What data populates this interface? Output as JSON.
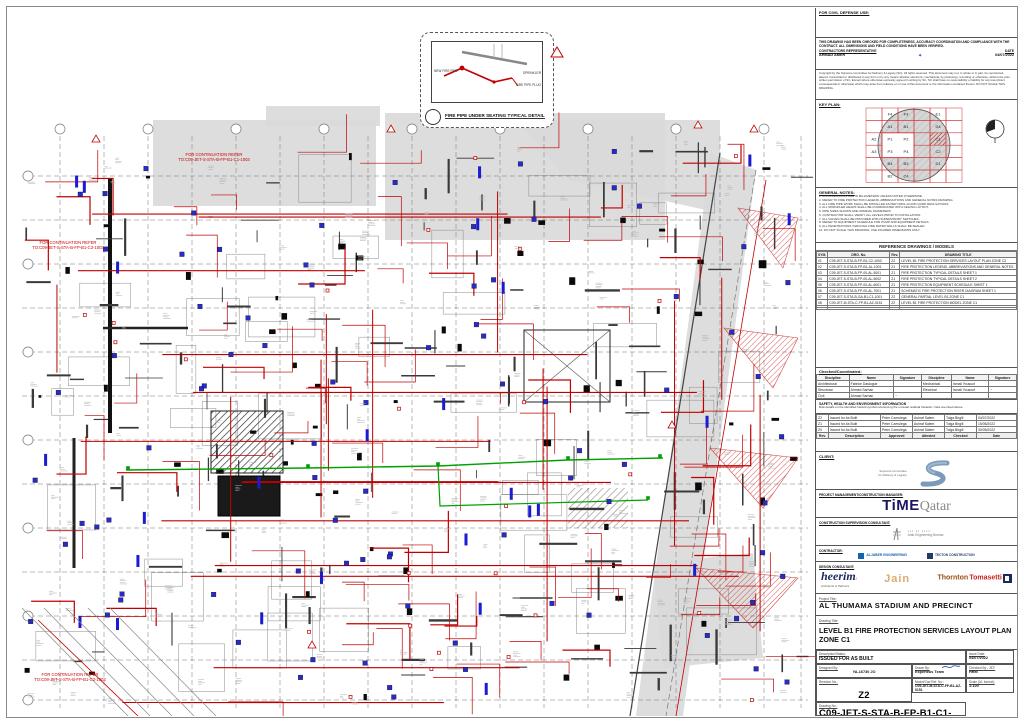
{
  "civil_defense": {
    "label": "FOR CIVIL DEFENSE USE:"
  },
  "compliance": {
    "statement": "THIS DRAWING HAS BEEN CHECKED FOR COMPLETENESS, ACCURACY COORDINATION AND COMPLIANCE WITH THE CONTRACT. ALL DIMENSIONS AND FIELD CONDITIONS HAVE BEEN VERIFIED.",
    "rep_label": "CONTRACTORS REPRESENTATIVE",
    "rep_name": "AHMAD AMER",
    "date_label": "DATE",
    "date": "04/07/2022"
  },
  "copyright": "Copyright by the Supreme Committee for Delivery & Legacy (SC). All rights reserved. This document may not, in whole or in part, be reproduced, altered, transmitted or distributed in any form or by any means whether electronic, mechanical, by photocopy, recording or otherwise, without the prior written permission of SC. Except where otherwise expressly agreed in writing by SC, SC shall have no responsibility or liability for any loss (direct, consequential or otherwise) which may arise from reliance on or use of this document or the information contained therein. DO NOT SCALE THIS DRAWING.",
  "keyplan": {
    "label": "KEY PLAN:",
    "grid": [
      [
        "",
        "F4",
        "F3",
        "",
        "E1",
        ""
      ],
      [
        "",
        "A1",
        "B1",
        "",
        "D4",
        ""
      ],
      [
        "A2",
        "P1",
        "P2",
        "",
        "C1",
        ""
      ],
      [
        "A3",
        "P3",
        "P4",
        "",
        "C2",
        ""
      ],
      [
        "",
        "B4",
        "B3",
        "",
        "D1",
        ""
      ],
      [
        "",
        "B2",
        "C4",
        "",
        "",
        ""
      ]
    ],
    "highlight_zone": "C1"
  },
  "general_notes": {
    "title": "GENERAL NOTES:",
    "lines": [
      "1. ALL DIMENSIONS ARE IN MILLIMETERS UNLESS NOTED OTHERWISE.",
      "2. REFER TO FIRE PROTECTION LEGEND, ABBREVIATIONS AND GENERAL NOTES DRAWING.",
      "3. ALL FIRE PIPE WORK SHALL BE INSTALLED AS PER NFPA-13 AND QCDD REGULATIONS.",
      "4. ALL SPRINKLER HEADS SHALL BE COORDINATED WITH CEILING LAYOUT.",
      "5. PIPE SIZES SHOWN ARE NOMINAL DIAMETERS.",
      "6. CONTRACTOR SHALL VERIFY ALL LEVELS PRIOR TO INSTALLATION.",
      "7. ALL VALVES SHALL BE PROVIDED WITH SUPERVISORY SWITCHES.",
      "8. REFER TO EQUIPMENT SCHEDULE FOR PUMP AND EQUIPMENT DETAILS.",
      "9. ALL PENETRATIONS THROUGH FIRE RATED WALLS SHALL BE SEALED.",
      "10. DO NOT SCALE THIS DRAWING; USE FIGURED DIMENSIONS ONLY."
    ]
  },
  "reference_table": {
    "title": "REFERENCE DRAWINGS / MODELS",
    "headers": [
      "SYM.",
      "DRG. No.",
      "Rev.",
      "DRAWING TITLE"
    ],
    "rows": [
      [
        "01",
        "C09-JET-S-STA-B-FP-B1-C2-1003",
        "Z2",
        "LEVEL B1 FIRE PROTECTION SERVICES LAYOUT PLAN ZONE C2"
      ],
      [
        "02",
        "C09-JET-S-STA-B-FP-B1-AL-1001",
        "Z1",
        "FIRE PROTECTION LEGEND, ABBREVIATIONS AND GENERAL NOTES"
      ],
      [
        "03",
        "C09-JET-S-STA-B-FP-00-AL-5001",
        "Z1",
        "FIRE PROTECTION TYPICAL DETAILS SHEET 1"
      ],
      [
        "04",
        "C09-JET-S-STA-B-FP-00-AL-5002",
        "Z1",
        "FIRE PROTECTION TYPICAL DETAILS SHEET 2"
      ],
      [
        "05",
        "C09-JET-S-STA-B-FP-00-AL-6001",
        "Z1",
        "FIRE PROTECTION EQUIPMENT SCHEDULE SHEET 1"
      ],
      [
        "06",
        "C09-JET-S-STA-B-FP-00-AL-7001",
        "Z1",
        "SCHEMATIC FIRE PROTECTION RISER DIAGRAM SHEET 1"
      ],
      [
        "07",
        "C09-JET-S-STA-B-GA-B1-C1-1001",
        "Z2",
        "GENERAL PARTIAL LEVEL B1 ZONE C1"
      ],
      [
        "08",
        "C09-JET-M-STA-C-FP-B1-AZ-0151",
        "Z2",
        "LEVEL B1 FIRE PROTECTION MODEL ZONE C1"
      ],
      [
        "",
        "",
        "",
        ""
      ],
      [
        "",
        "",
        "",
        ""
      ]
    ]
  },
  "checked": {
    "title": "Checked/Coordinated:",
    "headers": [
      "Discipline",
      "Name",
      "Signature",
      "Discipline",
      "Name",
      "Signature"
    ],
    "rows": [
      [
        "Architectural",
        "Fabrice Dastugue",
        "",
        "Mechanical",
        "Ismail Yousouf",
        ""
      ],
      [
        "Structural",
        "Ahmed Sarhan",
        "",
        "Electrical",
        "Ismail Yousouf",
        "~"
      ],
      [
        "Civil",
        "Ahmad Sarhan",
        "~",
        "",
        "",
        ""
      ]
    ]
  },
  "she": {
    "title": "SAFETY, HEALTH AND ENVIRONMENT INFORMATION",
    "text": "Risk details on the identified hazard symbol referencing the unusual residual hazards / risks are listed above."
  },
  "revisions": {
    "rows": [
      [
        "Z2",
        "Issued for As Built",
        "Peter Czerulega",
        "Ashraf Salem",
        "Tolga Birgili",
        "04/07/2022"
      ],
      [
        "Z1",
        "Issued for As Built",
        "Peter Czerulega",
        "Ashraf Salem",
        "Tolga Birgili",
        "15/06/2022"
      ],
      [
        "Z0",
        "Issued for As Built",
        "Peter Czerulega",
        "Ashraf Salem",
        "Tolga Birgili",
        "30/05/2022"
      ],
      [
        "Rev.",
        "Description",
        "Approved",
        "Attested",
        "Checked",
        "Date"
      ]
    ]
  },
  "parties": {
    "client_label": "CLIENT:",
    "client_line1": "Supreme Committee",
    "client_line2": "for Delivery & Legacy",
    "pm_label": "PROJECT MANAGEMENT/CONSTRUCTION MANAGER:",
    "pm_bold": "TiME",
    "pm_light": "Qatar",
    "csc_label": "CONSTRUCTION SUPERVISION CONSULTANT:",
    "csc_line1": "Arab Engineering Bureau",
    "contractor_label": "CONTRACTOR:",
    "contractor_1a": "ALJABER",
    "contractor_1b": "ENGINEERING",
    "contractor_2a": "TECTON",
    "contractor_2b": "CONSTRUCTION",
    "design_label": "DESIGN CONSULTANT:",
    "design_1": "heerim",
    "design_1_sub": "Architects & Partners",
    "design_2": "Jain",
    "design_3a": "Thornton",
    "design_3b": "Tomasetti"
  },
  "title_block": {
    "project_label": "Project Title:",
    "project": "AL THUMAMA STADIUM AND  PRECINCT",
    "drawing_label": "Drawing Title:",
    "drawing_line1": "LEVEL B1 FIRE PROTECTION SERVICES LAYOUT PLAN",
    "drawing_line2": "ZONE C1",
    "status_label": "Description/Status:",
    "status": "ISSUED FOR AS BUILT",
    "issue_date_label": "Issue Date:",
    "issue_date": "04/07/2022",
    "designed_label": "Designed By:",
    "designed": "YA-16730 JO",
    "drawn_label": "Drawn By:",
    "drawn": "Experteus Team",
    "checked_label": "Checked By - JET:",
    "checked": "HRM",
    "model_label": "Model/Cad Ref. No.:",
    "model": "C09-JET-M-STA-C-FP-B1-AZ-0151",
    "scale_label": "Scale (A1 format):",
    "scale": "1:100",
    "rev_label": "Revision No.:",
    "rev": "Z2",
    "drgno_label": "Drawing No.:",
    "drgno": "C09-JET-S-STA-B-FP-B1-C1-1003"
  },
  "plan": {
    "detail": {
      "caption": "FIRE PIPE UNDER SEATING TYPICAL DETAIL",
      "label_left": "NEW FIRE PIPE",
      "label_right1": "SPRINKLER",
      "label_right2": "FIRE PIPE PLUG"
    },
    "continuation_top_1": "FOR CONTINUATION REFER",
    "continuation_top_2": "TO:C09-JET-S-STA-B-FP-B1-C1-1003",
    "continuation_left_1": "FOR CONTINUATION REFER",
    "continuation_left_2": "TO:C09-JET-S-STA-B-FP-B1-C3-1003",
    "continuation_bottom_1": "FOR CONTINUATION REFER",
    "continuation_bottom_2": "TO:C09-JET-S-STA-B-FP-B1-C2-1003"
  },
  "colors": {
    "pipe_red": "#c00000",
    "device_blue": "#2a2ac8",
    "main_green": "#00a000",
    "shade_gray": "#d9d9d9"
  }
}
